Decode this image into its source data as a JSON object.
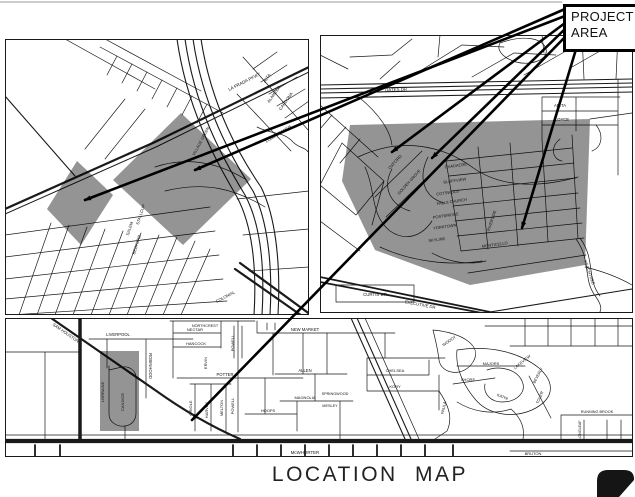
{
  "page": {
    "title": "LOCATION MAP",
    "background": "#ffffff",
    "line_color": "#1a1a1a",
    "shade_color": "#000000",
    "shade_opacity": 0.42
  },
  "callout": {
    "line1": "PROJECT",
    "line2": "AREA"
  },
  "maps": [
    {
      "id": "A",
      "name": "upper-left-street-map",
      "labels": [
        {
          "t": "LA PRADA PKWY",
          "x": 240,
          "y": 44,
          "r": -27,
          "s": 4.4
        },
        {
          "t": "ALTA",
          "x": 263,
          "y": 40,
          "r": -55,
          "s": 4.2
        },
        {
          "t": "ALAMEDA",
          "x": 270,
          "y": 56,
          "r": -55,
          "s": 4.2
        },
        {
          "t": "CARDONA",
          "x": 282,
          "y": 63,
          "r": -55,
          "s": 4.2
        },
        {
          "t": "LONG BRANCH",
          "x": 274,
          "y": 96,
          "r": -32,
          "s": 4
        },
        {
          "t": "VILLAGE GREEN",
          "x": 197,
          "y": 103,
          "r": -62,
          "s": 4
        },
        {
          "t": "STALLCUP",
          "x": 137,
          "y": 176,
          "r": -72,
          "s": 4.2
        },
        {
          "t": "SALEM",
          "x": 126,
          "y": 190,
          "r": -72,
          "s": 4.2
        },
        {
          "t": "BEDFORD",
          "x": 133,
          "y": 206,
          "r": -72,
          "s": 4.2
        },
        {
          "t": "COLONIAL",
          "x": 221,
          "y": 259,
          "r": -28,
          "s": 4.2
        }
      ]
    },
    {
      "id": "B",
      "name": "upper-right-street-map",
      "labels": [
        {
          "t": "OATES DR",
          "x": 76,
          "y": 56,
          "r": -2,
          "s": 4.4
        },
        {
          "t": "ANITA",
          "x": 240,
          "y": 72,
          "r": 0,
          "s": 4.2
        },
        {
          "t": "LOYCE",
          "x": 242,
          "y": 86,
          "r": 0,
          "s": 4.2
        },
        {
          "t": "OXFORD",
          "x": 76,
          "y": 128,
          "r": -48,
          "s": 4.2
        },
        {
          "t": "GOLDEN GROVE",
          "x": 90,
          "y": 148,
          "r": -48,
          "s": 4
        },
        {
          "t": "CHADACRE",
          "x": 136,
          "y": 132,
          "r": -8,
          "s": 4
        },
        {
          "t": "BLUFFVIEW",
          "x": 135,
          "y": 147,
          "r": -8,
          "s": 4
        },
        {
          "t": "COTSWOLD",
          "x": 128,
          "y": 159,
          "r": -8,
          "s": 4
        },
        {
          "t": "FALLS CHURCH",
          "x": 132,
          "y": 168,
          "r": -8,
          "s": 4
        },
        {
          "t": "POSTBRIDGE",
          "x": 126,
          "y": 182,
          "r": -8,
          "s": 4
        },
        {
          "t": "YORKTOWN",
          "x": 125,
          "y": 193,
          "r": -8,
          "s": 4
        },
        {
          "t": "SKYLINE",
          "x": 117,
          "y": 206,
          "r": -8,
          "s": 4
        },
        {
          "t": "MONTICELLO",
          "x": 175,
          "y": 211,
          "r": -8,
          "s": 4
        },
        {
          "t": "RIVERSIDE",
          "x": 173,
          "y": 186,
          "r": -72,
          "s": 4
        },
        {
          "t": "CURTIS DR",
          "x": 55,
          "y": 261,
          "r": 0,
          "s": 4.4
        },
        {
          "t": "EXECUTIVE DR",
          "x": 100,
          "y": 271,
          "r": 11,
          "s": 4.2
        },
        {
          "t": "PEACHTREE",
          "x": 268,
          "y": 238,
          "r": 70,
          "s": 4.2
        }
      ]
    },
    {
      "id": "C",
      "name": "bottom-street-map",
      "labels": [
        {
          "t": "SAM HOUSTON",
          "x": 60,
          "y": 16,
          "r": 35,
          "s": 4.2
        },
        {
          "t": "LIVERPOOL",
          "x": 113,
          "y": 18,
          "r": 0,
          "s": 4.2
        },
        {
          "t": "ROBINHOOD",
          "x": 144,
          "y": 48,
          "r": 90,
          "s": 4.2
        },
        {
          "t": "LORRAINE",
          "x": 99,
          "y": 74,
          "r": -90,
          "s": 4
        },
        {
          "t": "CANDICE",
          "x": 119,
          "y": 84,
          "r": -90,
          "s": 4
        },
        {
          "t": "NORTHCREST",
          "x": 200,
          "y": 9,
          "r": 0,
          "s": 3.8
        },
        {
          "t": "NECTAR",
          "x": 190,
          "y": 13,
          "r": 0,
          "s": 4
        },
        {
          "t": "HANCOCK",
          "x": 191,
          "y": 27,
          "r": 0,
          "s": 4
        },
        {
          "t": "POWELL",
          "x": 229,
          "y": 25,
          "r": -90,
          "s": 4
        },
        {
          "t": "POWELL",
          "x": 229,
          "y": 88,
          "r": -90,
          "s": 4
        },
        {
          "t": "NEW MARKET",
          "x": 300,
          "y": 13,
          "r": 0,
          "s": 4.2
        },
        {
          "t": "ERVIN",
          "x": 202,
          "y": 45,
          "r": -90,
          "s": 4
        },
        {
          "t": "POTTER",
          "x": 220,
          "y": 58,
          "r": 0,
          "s": 4.2
        },
        {
          "t": "ALLEN",
          "x": 300,
          "y": 54,
          "r": 0,
          "s": 4.2
        },
        {
          "t": "MAGNOLIA",
          "x": 300,
          "y": 81,
          "r": 0,
          "s": 4
        },
        {
          "t": "HOOPS",
          "x": 263,
          "y": 94,
          "r": 0,
          "s": 4
        },
        {
          "t": "MELTON",
          "x": 218,
          "y": 90,
          "r": -90,
          "s": 4
        },
        {
          "t": "HARVEY",
          "x": 203,
          "y": 92,
          "r": -90,
          "s": 4
        },
        {
          "t": "ORIOLE",
          "x": 187,
          "y": 90,
          "r": -90,
          "s": 4
        },
        {
          "t": "McWHORTER",
          "x": 300,
          "y": 136,
          "r": 0,
          "s": 4.4
        },
        {
          "t": "WOODY",
          "x": 445,
          "y": 24,
          "r": -35,
          "s": 4
        },
        {
          "t": "CHELSEA",
          "x": 390,
          "y": 54,
          "r": 0,
          "s": 4
        },
        {
          "t": "KORY",
          "x": 390,
          "y": 70,
          "r": 0,
          "s": 4
        },
        {
          "t": "PAULA",
          "x": 440,
          "y": 90,
          "r": -78,
          "s": 4
        },
        {
          "t": "SHORE",
          "x": 463,
          "y": 63,
          "r": 0,
          "s": 4
        },
        {
          "t": "SPRINGWOOD",
          "x": 330,
          "y": 77,
          "r": 0,
          "s": 3.8
        },
        {
          "t": "MESLEY",
          "x": 325,
          "y": 89,
          "r": 0,
          "s": 3.8
        },
        {
          "t": "MAJORS",
          "x": 486,
          "y": 47,
          "r": 0,
          "s": 4
        },
        {
          "t": "LAKEVIEW",
          "x": 518,
          "y": 45,
          "r": -40,
          "s": 4
        },
        {
          "t": "BEVERLY",
          "x": 534,
          "y": 58,
          "r": -62,
          "s": 3.8
        },
        {
          "t": "KATHI",
          "x": 497,
          "y": 80,
          "r": 22,
          "s": 4
        },
        {
          "t": "TOLER",
          "x": 536,
          "y": 80,
          "r": -68,
          "s": 4
        },
        {
          "t": "RUNNING BROOK",
          "x": 592,
          "y": 95,
          "r": 0,
          "s": 3.8
        },
        {
          "t": "LONGLEAF",
          "x": 576,
          "y": 112,
          "r": -90,
          "s": 3.6
        },
        {
          "t": "BRUTON",
          "x": 528,
          "y": 137,
          "r": 0,
          "s": 4
        }
      ]
    }
  ]
}
